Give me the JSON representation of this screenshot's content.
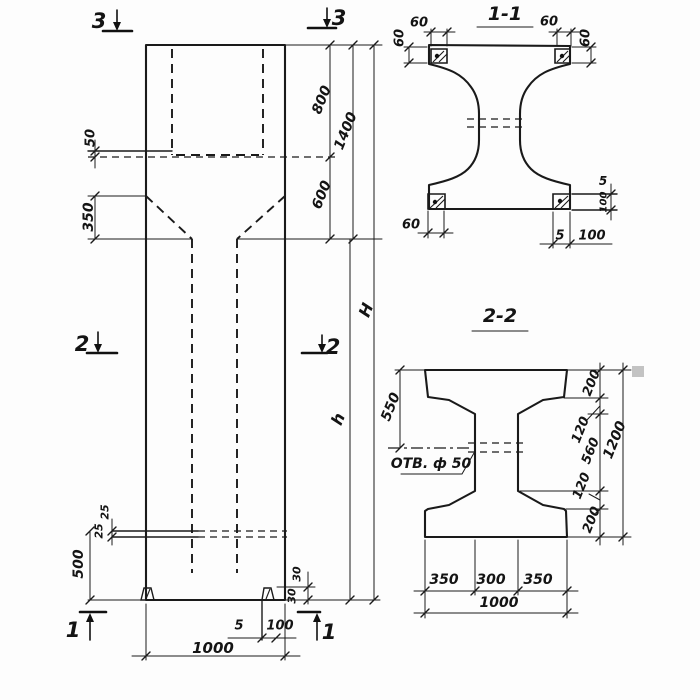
{
  "drawing": {
    "kind": "technical-drawing",
    "ink_color": "#1a1a1a",
    "paper_color": "#fdfdfd",
    "views": {
      "elevation": {
        "description": "column front elevation"
      },
      "section_1_1": {
        "title": "1-1"
      },
      "section_2_2": {
        "title": "2-2"
      }
    },
    "labels": [
      {
        "name": "section-marker-3-left",
        "text": "3",
        "x": 99,
        "y": 21,
        "rot": 0,
        "size": 21
      },
      {
        "name": "section-marker-3-right",
        "text": "3",
        "x": 339,
        "y": 18,
        "rot": 0,
        "size": 21
      },
      {
        "name": "section-marker-2-left",
        "text": "2",
        "x": 82,
        "y": 344,
        "rot": 0,
        "size": 21
      },
      {
        "name": "section-marker-2-right",
        "text": "2",
        "x": 333,
        "y": 347,
        "rot": 0,
        "size": 21
      },
      {
        "name": "section-marker-1-left",
        "text": "1",
        "x": 73,
        "y": 630,
        "rot": 0,
        "size": 21
      },
      {
        "name": "section-marker-1-right",
        "text": "1",
        "x": 329,
        "y": 632,
        "rot": 0,
        "size": 21
      },
      {
        "name": "dim-50-neck",
        "text": "50",
        "x": 91,
        "y": 138,
        "rot": -90,
        "size": 13
      },
      {
        "name": "dim-350-taper",
        "text": "350",
        "x": 89,
        "y": 217,
        "rot": -90,
        "size": 14
      },
      {
        "name": "dim-500-foot",
        "text": "500",
        "x": 79,
        "y": 564,
        "rot": -90,
        "size": 14
      },
      {
        "name": "dim-25-upper",
        "text": "25",
        "x": 105,
        "y": 512,
        "rot": -90,
        "size": 11
      },
      {
        "name": "dim-25-lower",
        "text": "25",
        "x": 99,
        "y": 531,
        "rot": -90,
        "size": 11
      },
      {
        "name": "dim-800",
        "text": "800",
        "x": 322,
        "y": 100,
        "rot": -68,
        "size": 14
      },
      {
        "name": "dim-1400",
        "text": "1400",
        "x": 346,
        "y": 131,
        "rot": -68,
        "size": 14
      },
      {
        "name": "dim-600",
        "text": "600",
        "x": 322,
        "y": 195,
        "rot": -68,
        "size": 14
      },
      {
        "name": "dim-H",
        "text": "H",
        "x": 366,
        "y": 310,
        "rot": -68,
        "size": 16
      },
      {
        "name": "dim-h",
        "text": "h",
        "x": 338,
        "y": 419,
        "rot": -68,
        "size": 16
      },
      {
        "name": "dim-1000-elevation",
        "text": "1000",
        "x": 213,
        "y": 648,
        "rot": 0,
        "size": 15
      },
      {
        "name": "dim-5-foot",
        "text": "5",
        "x": 239,
        "y": 626,
        "rot": 0,
        "size": 13
      },
      {
        "name": "dim-100-foot",
        "text": "100",
        "x": 280,
        "y": 626,
        "rot": 0,
        "size": 13
      },
      {
        "name": "dim-30-upper",
        "text": "30",
        "x": 297,
        "y": 574,
        "rot": -90,
        "size": 11
      },
      {
        "name": "dim-30-lower",
        "text": "30",
        "x": 292,
        "y": 596,
        "rot": -90,
        "size": 11
      },
      {
        "name": "section-1-1-title",
        "text": "1-1",
        "x": 505,
        "y": 14,
        "rot": 0,
        "size": 19
      },
      {
        "name": "dim-60-topleft",
        "text": "60",
        "x": 419,
        "y": 23,
        "rot": 0,
        "size": 13
      },
      {
        "name": "dim-60-topright",
        "text": "60",
        "x": 549,
        "y": 22,
        "rot": 0,
        "size": 13
      },
      {
        "name": "dim-60-left-vert",
        "text": "60",
        "x": 400,
        "y": 38,
        "rot": -90,
        "size": 13
      },
      {
        "name": "dim-60-right-vert",
        "text": "60",
        "x": 586,
        "y": 38,
        "rot": -90,
        "size": 13
      },
      {
        "name": "dim-60-bottomleft",
        "text": "60",
        "x": 411,
        "y": 225,
        "rot": 0,
        "size": 13
      },
      {
        "name": "dim-5-bottom",
        "text": "5",
        "x": 560,
        "y": 236,
        "rot": 0,
        "size": 13
      },
      {
        "name": "dim-100-bottom",
        "text": "100",
        "x": 592,
        "y": 236,
        "rot": 0,
        "size": 13
      },
      {
        "name": "dim-5-right",
        "text": "5",
        "x": 603,
        "y": 181,
        "rot": 0,
        "size": 12
      },
      {
        "name": "dim-100-right",
        "text": "100",
        "x": 604,
        "y": 202,
        "rot": -90,
        "size": 10
      },
      {
        "name": "section-2-2-title",
        "text": "2-2",
        "x": 500,
        "y": 316,
        "rot": 0,
        "size": 19
      },
      {
        "name": "dim-550",
        "text": "550",
        "x": 391,
        "y": 407,
        "rot": -68,
        "size": 14
      },
      {
        "name": "hole-callout",
        "text": "ОТВ. ф 50",
        "x": 431,
        "y": 464,
        "rot": 0,
        "size": 14
      },
      {
        "name": "dim-200-top",
        "text": "200",
        "x": 592,
        "y": 383,
        "rot": -68,
        "size": 13
      },
      {
        "name": "dim-120-top",
        "text": "120",
        "x": 581,
        "y": 430,
        "rot": -68,
        "size": 13
      },
      {
        "name": "dim-560",
        "text": "560",
        "x": 591,
        "y": 451,
        "rot": -68,
        "size": 13
      },
      {
        "name": "dim-120-bottom",
        "text": "120",
        "x": 582,
        "y": 486,
        "rot": -68,
        "size": 13
      },
      {
        "name": "dim-200-bottom",
        "text": "200",
        "x": 592,
        "y": 520,
        "rot": -68,
        "size": 13
      },
      {
        "name": "dim-1200",
        "text": "1200",
        "x": 615,
        "y": 440,
        "rot": -68,
        "size": 14
      },
      {
        "name": "dim-350-left",
        "text": "350",
        "x": 444,
        "y": 580,
        "rot": 0,
        "size": 14
      },
      {
        "name": "dim-300",
        "text": "300",
        "x": 491,
        "y": 580,
        "rot": 0,
        "size": 14
      },
      {
        "name": "dim-350-right",
        "text": "350",
        "x": 538,
        "y": 580,
        "rot": 0,
        "size": 14
      },
      {
        "name": "dim-1000-section",
        "text": "1000",
        "x": 499,
        "y": 603,
        "rot": 0,
        "size": 14
      }
    ]
  }
}
